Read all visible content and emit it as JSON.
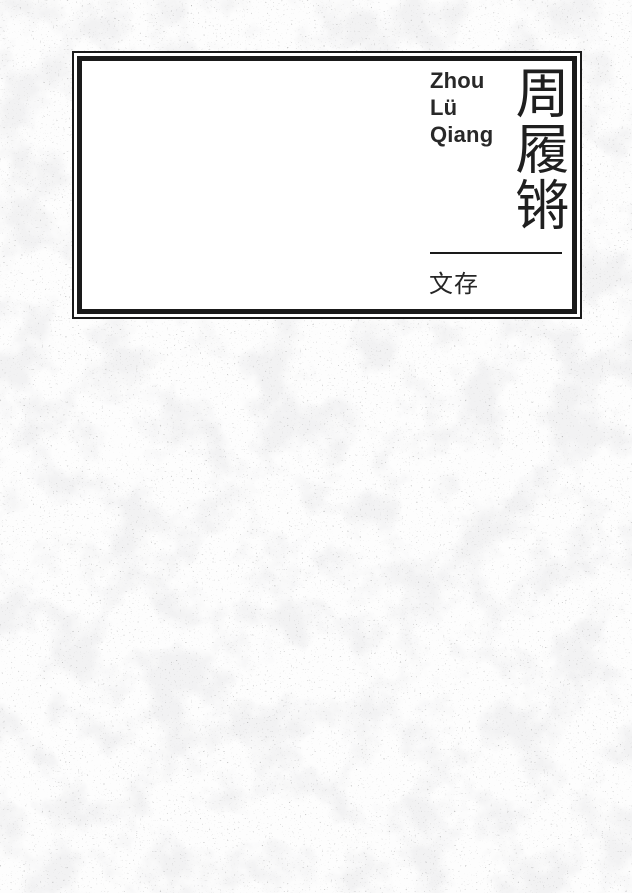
{
  "cover": {
    "author_latin": "Zhou\nLü\nQiang",
    "title_cjk": "周履锵",
    "subtitle_cjk": "文存",
    "colors": {
      "frame_ink": "#1a1a1a",
      "latin_text": "#282828",
      "cjk_text": "#1f1f1f",
      "box_background": "#ffffff",
      "texture_splotch": "#e2e2e4",
      "texture_speckle": "#6e6e6e",
      "page_background": "#fdfdfd"
    }
  }
}
